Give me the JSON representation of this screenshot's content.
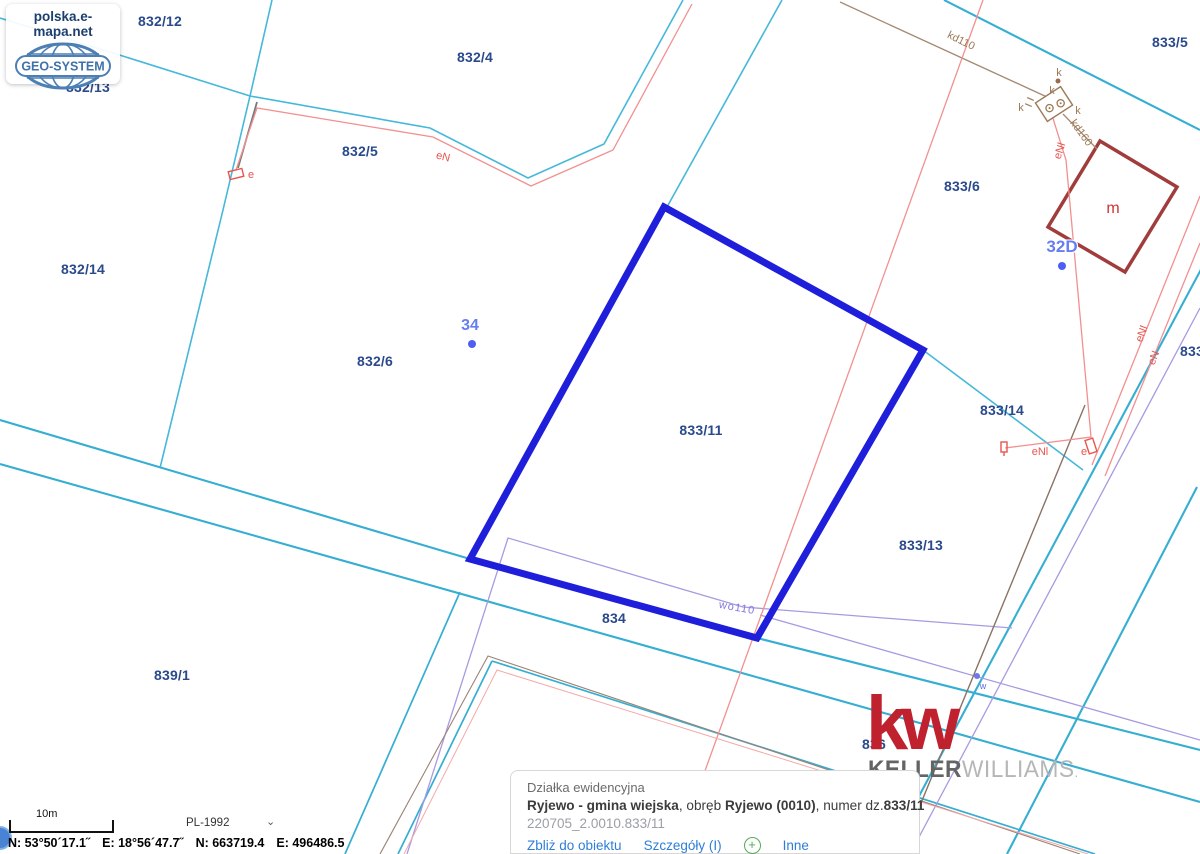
{
  "colors": {
    "parcel_line": "#46b8d9",
    "road_line": "#35aed2",
    "selection_blue": "#1e1edb",
    "label_navy": "#2a4a8c",
    "utility_red": "#f29090",
    "utility_brown": "#a58a72",
    "utility_violet": "#a89ae0",
    "building_red": "#a13c3c",
    "kw_red": "#bf222e",
    "link_blue": "#2e7ed8",
    "plus_green": "#52ab57"
  },
  "brand": {
    "site_label": "polska.e-mapa.net",
    "geo_system": "GEO-SYSTEM"
  },
  "kw_logo": {
    "monogram": "kw",
    "keller": "KELLER",
    "williams": "WILLIAMS",
    "dot": "."
  },
  "map": {
    "parcel_labels": [
      "832/12",
      "832/13",
      "832/4",
      "832/5",
      "832/14",
      "832/6",
      "833/5",
      "833/6",
      "833/11",
      "833/14",
      "833/13",
      "834",
      "839/1",
      "833",
      "836"
    ],
    "address_labels": [
      "34",
      "32D"
    ],
    "utility_labels": {
      "en_top": "eN",
      "e_left": "e",
      "enl_top": "eNl",
      "kd110": "kd110",
      "kd160": "kd160",
      "k1": "k",
      "k2": "k",
      "k3": "k",
      "k4": "k",
      "m": "m",
      "enl_mid": "eNl",
      "e_mid": "e",
      "enl_right": "eNl",
      "en_right": "eN",
      "wo110": "wo110",
      "w": "w"
    }
  },
  "info_panel": {
    "title": "Działka ewidencyjna",
    "name_bold": "Ryjewo - gmina wiejska",
    "sep1": ", obręb ",
    "obreb_bold": "Ryjewo (0010)",
    "sep2": ", numer dz.",
    "number_bold": "833/11",
    "id": "220705_2.0010.833/11",
    "links": {
      "zoom_to_object": "Zbliż do obiektu",
      "details": "Szczegóły (I)",
      "more": "Inne"
    },
    "plus": "+"
  },
  "status_bar": {
    "scale": "10m",
    "crs": "PL-1992",
    "chevron": "⌄",
    "geo_n": "N: 53°50´17.1˝",
    "geo_e": "E: 18°56´47.7˝",
    "grid_n": "N: 663719.4",
    "grid_e": "E: 496486.5"
  }
}
